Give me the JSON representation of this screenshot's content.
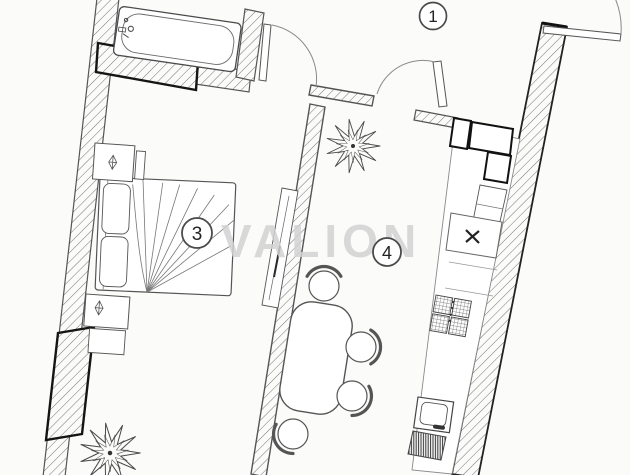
{
  "document": {
    "title": "apartment floor plan",
    "watermark": "VALION"
  },
  "rooms": [
    {
      "number": "1"
    },
    {
      "number": "3"
    },
    {
      "number": "4"
    }
  ],
  "colors": {
    "background": "#fbfbfa",
    "line": "#4a4a4a",
    "hatch": "#767676",
    "highlight_wall": "#151515",
    "watermark": "#d1d1d1"
  }
}
